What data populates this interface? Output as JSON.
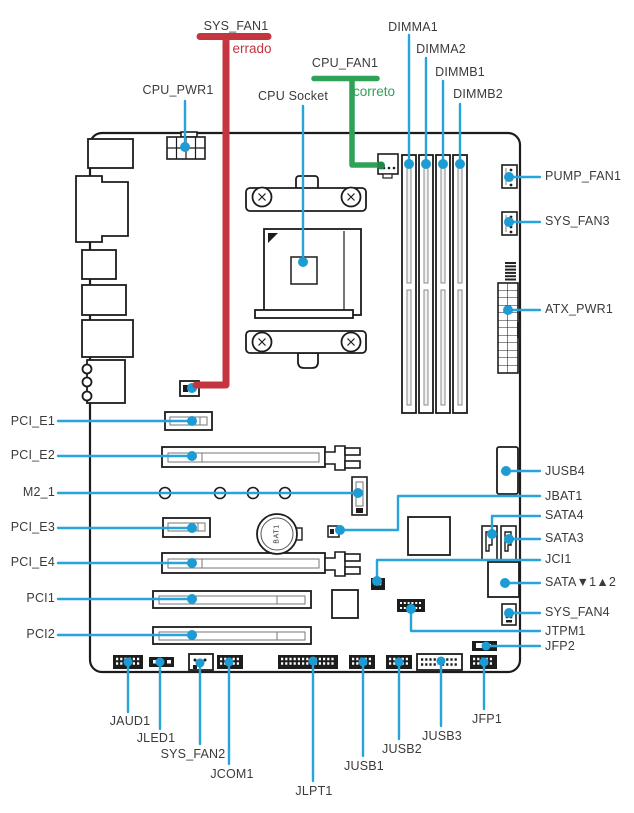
{
  "colors": {
    "callout": "#29a4db",
    "callout_dot": "#1d9bd3",
    "error": "#c4353f",
    "ok": "#2fa258",
    "ok_dot": "#1f8747",
    "outline": "#1c1c1c",
    "text": "#3b3b3b"
  },
  "annotations": {
    "wrong": "errado",
    "correct": "correto"
  },
  "battery_label": "BAT1",
  "labels": {
    "sys_fan1": "SYS_FAN1",
    "cpu_pwr1": "CPU_PWR1",
    "cpu_socket": "CPU Socket",
    "cpu_fan1": "CPU_FAN1",
    "dimma1": "DIMMA1",
    "dimma2": "DIMMA2",
    "dimmb1": "DIMMB1",
    "dimmb2": "DIMMB2",
    "pump_fan1": "PUMP_FAN1",
    "sys_fan3": "SYS_FAN3",
    "atx_pwr1": "ATX_PWR1",
    "jusb4": "JUSB4",
    "jbat1": "JBAT1",
    "sata4": "SATA4",
    "sata3": "SATA3",
    "jci1": "JCI1",
    "sata12": "SATA▼1▲2",
    "sys_fan4": "SYS_FAN4",
    "jtpm1": "JTPM1",
    "jfp2": "JFP2",
    "pci_e1": "PCI_E1",
    "pci_e2": "PCI_E2",
    "m2_1": "M2_1",
    "pci_e3": "PCI_E3",
    "pci_e4": "PCI_E4",
    "pci1": "PCI1",
    "pci2": "PCI2",
    "jaud1": "JAUD1",
    "jled1": "JLED1",
    "sys_fan2": "SYS_FAN2",
    "jcom1": "JCOM1",
    "jlpt1": "JLPT1",
    "jusb1": "JUSB1",
    "jusb2": "JUSB2",
    "jusb3": "JUSB3",
    "jfp1": "JFP1"
  }
}
